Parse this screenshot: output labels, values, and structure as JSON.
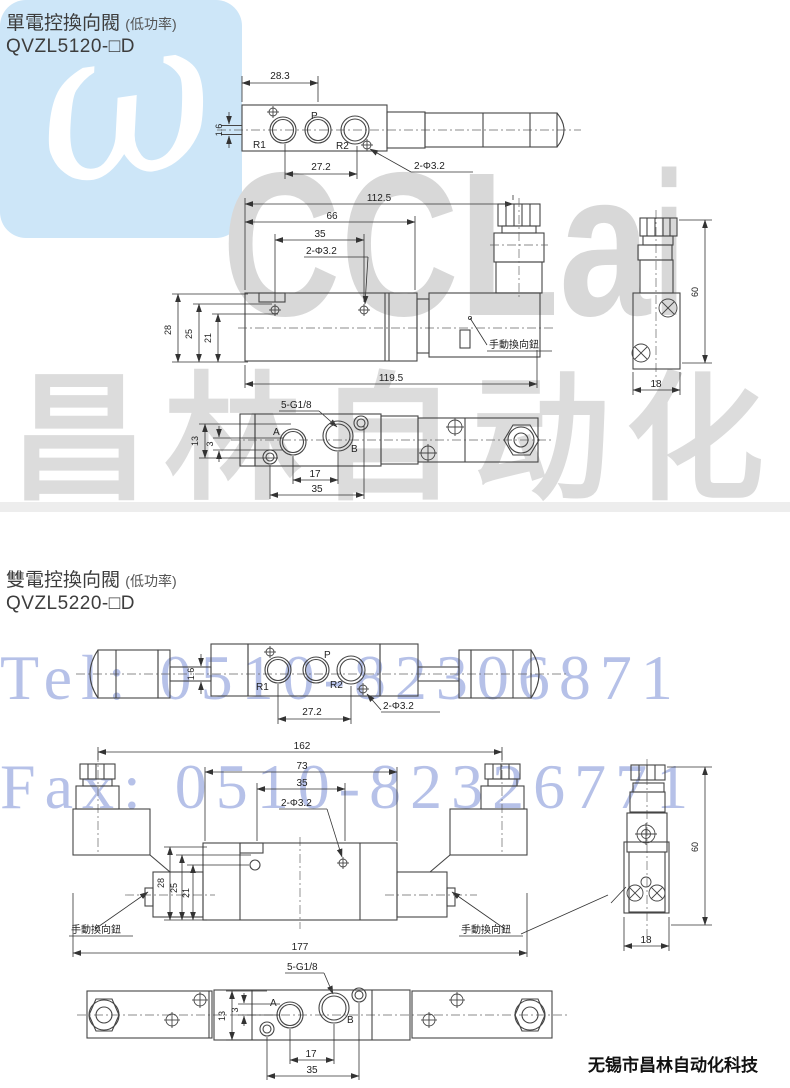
{
  "watermark": {
    "logo_glyph": "ω",
    "brand": "CCLair",
    "brand_cn": "昌林自动化",
    "tel": "Tel: 0510-82306871",
    "fax": "Fax: 0510-82326771"
  },
  "footer": {
    "company": "无锡市昌林自动化科技"
  },
  "sections": [
    {
      "title": "單電控換向閥",
      "subtitle": "(低功率)",
      "model": "QVZL5120-□D",
      "top": {
        "w": "28.3",
        "t": "1.6",
        "spacing": "27.2",
        "holes": "2-Φ3.2",
        "r1": "R1",
        "p": "P",
        "r2": "R2"
      },
      "front": {
        "l1": "112.5",
        "l2": "66",
        "l3": "35",
        "holes": "2-Φ3.2",
        "h1": "28",
        "h2": "25",
        "h3": "21",
        "len": "119.5",
        "knob": "手動換向鈕"
      },
      "side": {
        "h": "60",
        "w": "18"
      },
      "bottom": {
        "thread": "5-G1/8",
        "h1": "13",
        "h2": "3",
        "a": "A",
        "b": "B",
        "d1": "17",
        "d2": "35"
      }
    },
    {
      "title": "雙電控換向閥",
      "subtitle": "(低功率)",
      "model": "QVZL5220-□D",
      "top": {
        "t": "1.6",
        "spacing": "27.2",
        "holes": "2-Φ3.2",
        "r1": "R1",
        "p": "P",
        "r2": "R2"
      },
      "front": {
        "l1": "162",
        "l2": "73",
        "l3": "35",
        "holes": "2-Φ3.2",
        "h1": "28",
        "h2": "25",
        "h3": "21",
        "len": "177",
        "knob_left": "手動換向鈕",
        "knob_right": "手動換向鈕"
      },
      "side": {
        "h": "60",
        "w": "18"
      },
      "bottom": {
        "thread": "5-G1/8",
        "h1": "13",
        "h2": "3",
        "a": "A",
        "b": "B",
        "d1": "17",
        "d2": "35"
      }
    }
  ]
}
